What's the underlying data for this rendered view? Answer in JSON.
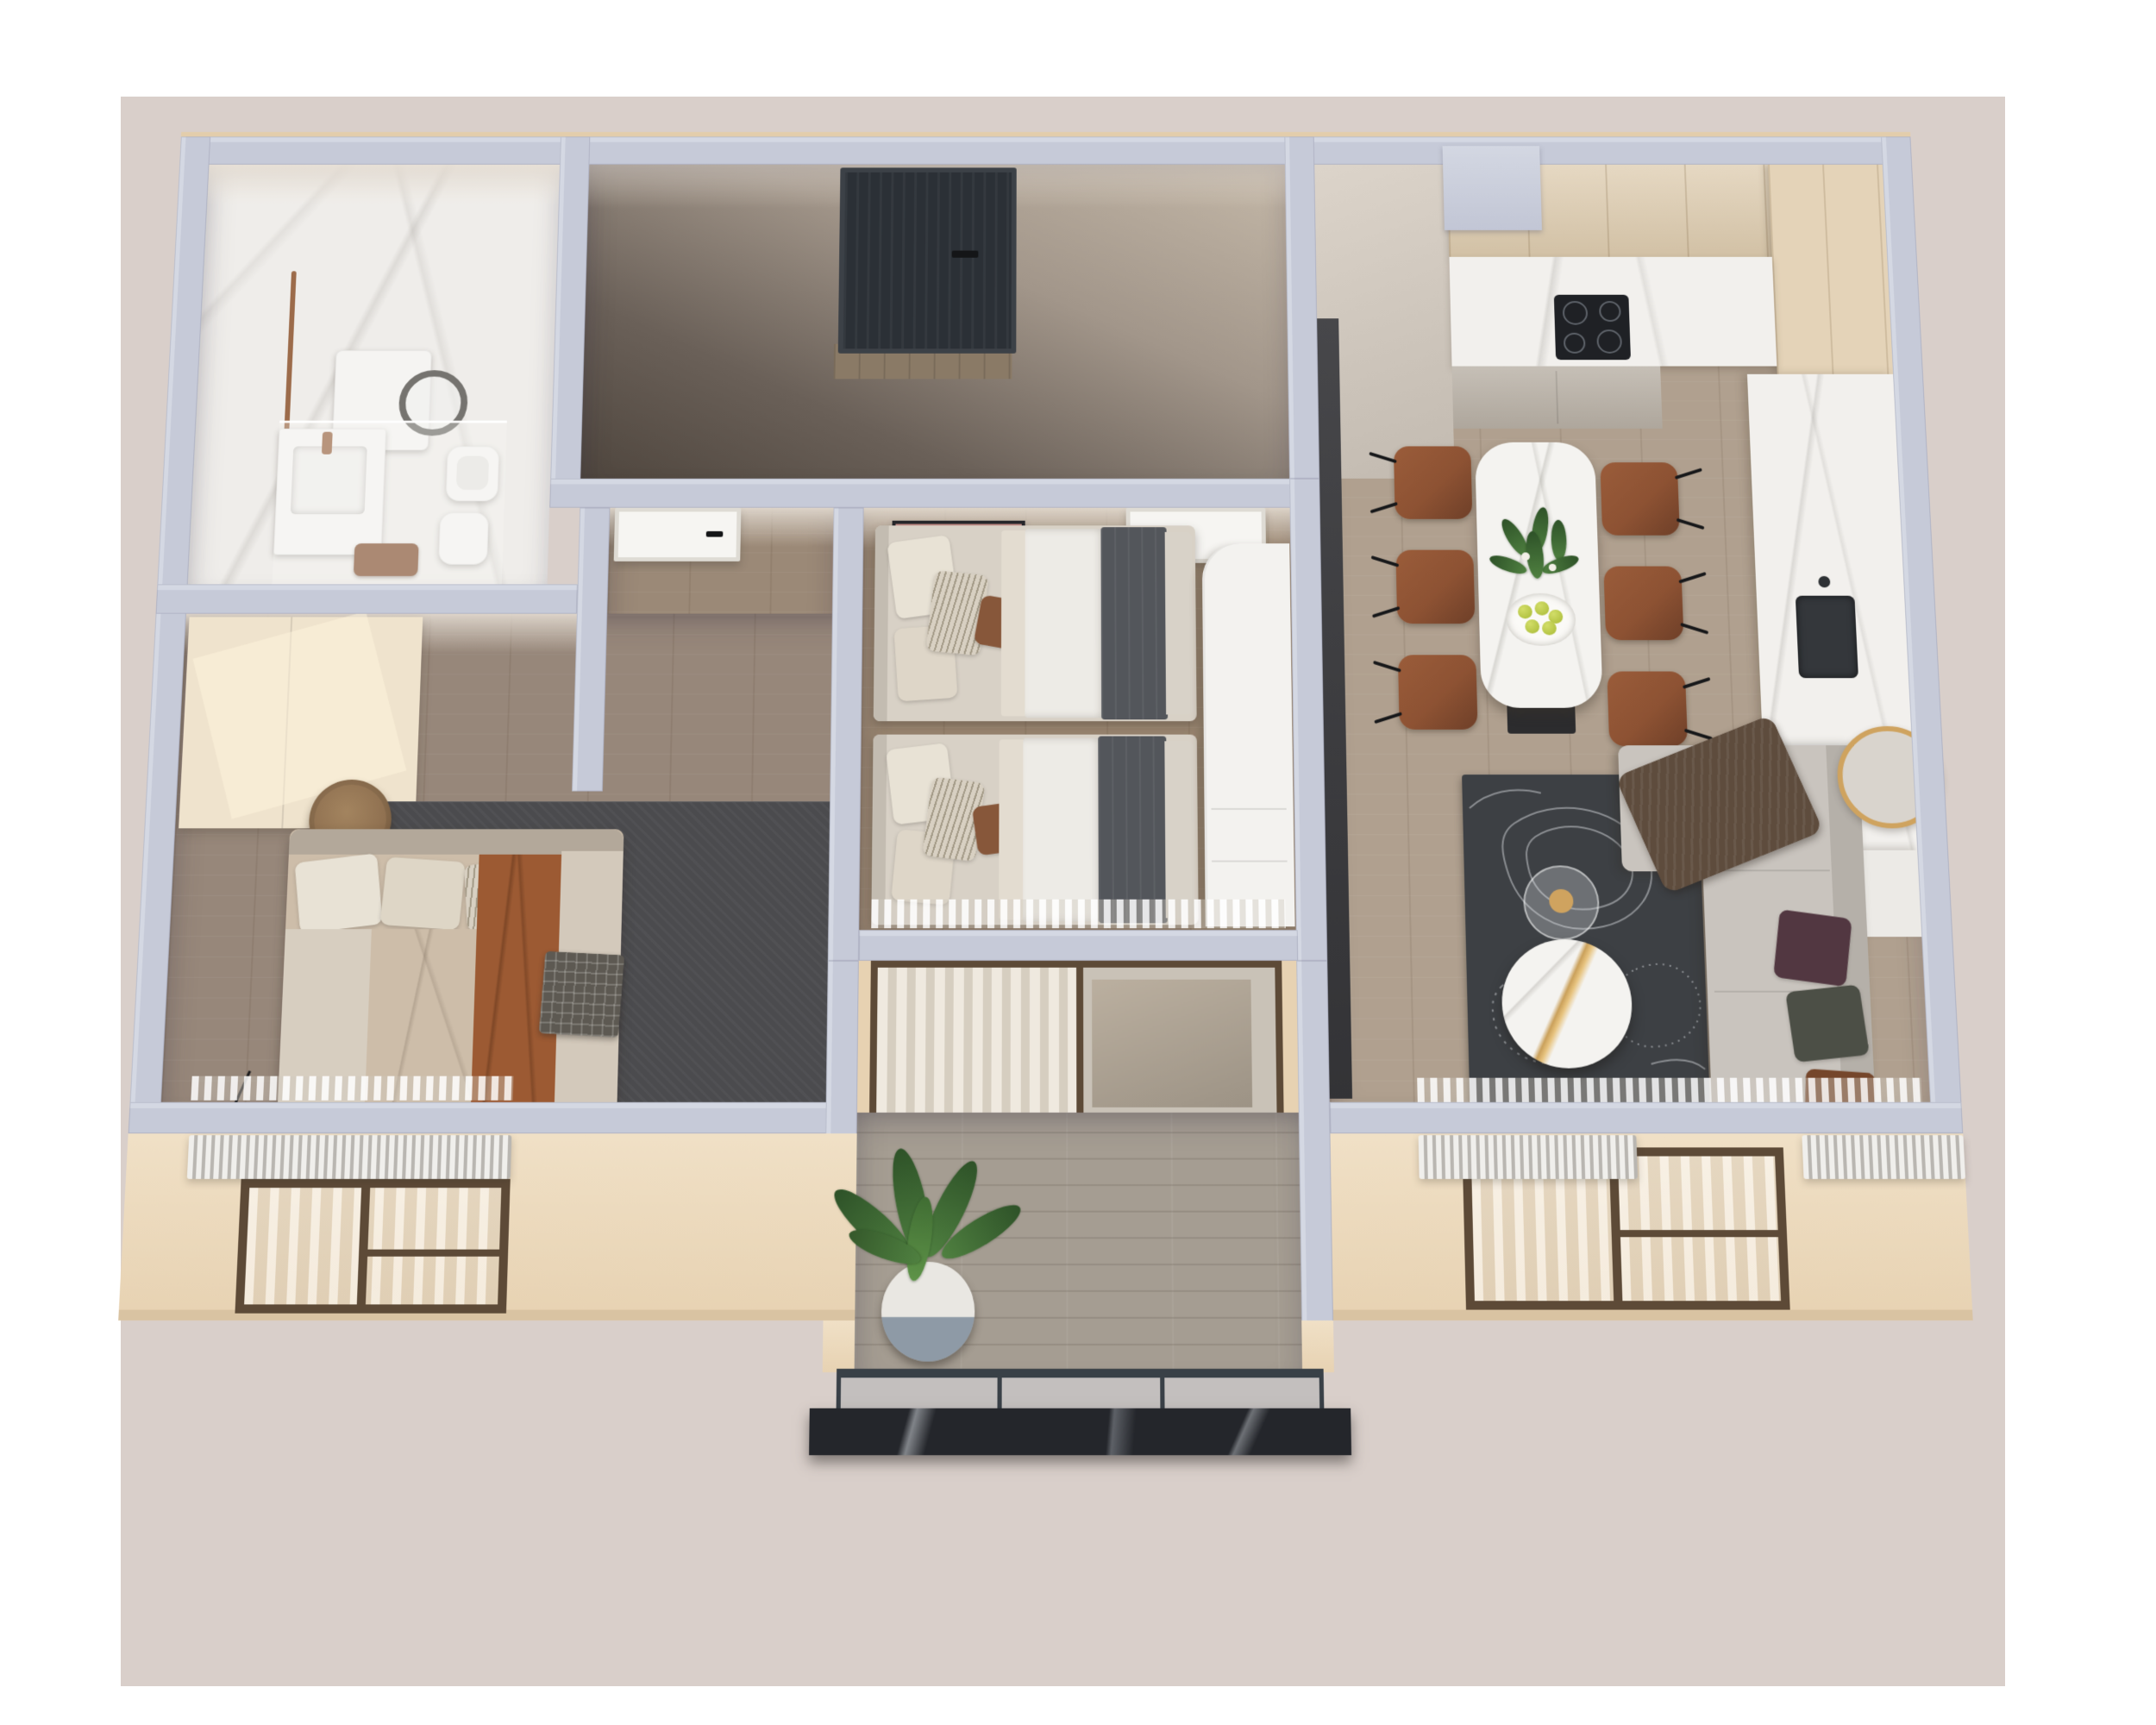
{
  "scene": {
    "kind": "isometric-3d-floor-plan-render",
    "rooms": {
      "bathroom": {
        "label": "Bathroom",
        "furniture": [
          "washing machine",
          "vanity sink",
          "shower glass panel",
          "toilet",
          "bidet",
          "copper towel rail",
          "brown towel"
        ]
      },
      "entry_hall": {
        "label": "Entry hall",
        "furniture": [
          "dark entrance door",
          "wood threshold"
        ]
      },
      "hallway": {
        "label": "Hallway",
        "furniture": [
          "white interior door",
          "light wood dresser"
        ]
      },
      "bedroom_master": {
        "label": "Master bedroom",
        "furniture": [
          "double bed",
          "rust throw blanket",
          "plaid blanket",
          "cream wardrobe",
          "round wood stool",
          "dark area rug",
          "floor lamp",
          "radiator",
          "curtains"
        ]
      },
      "bedroom_kids": {
        "label": "Second bedroom",
        "furniture": [
          "single bed upper",
          "single bed lower",
          "framed wall art",
          "white interior door",
          "white wardrobe",
          "sheer curtains"
        ]
      },
      "kitchen": {
        "label": "Kitchen",
        "furniture": [
          "upper cabinets",
          "tall cabinets",
          "marble counter",
          "induction cooktop",
          "dark sink",
          "white base cabinet"
        ]
      },
      "dining": {
        "label": "Dining area",
        "furniture": [
          "marble dining table",
          "six cognac leather chairs",
          "plant centerpiece",
          "plate of green apples"
        ]
      },
      "living": {
        "label": "Living area",
        "furniture": [
          "corner sofa",
          "three cushions",
          "brown throw",
          "topographic pattern rug",
          "round marble coffee table",
          "glass side table",
          "dark media panel",
          "round gold mirror",
          "radiators",
          "curtains"
        ]
      },
      "balcony": {
        "label": "Balcony",
        "furniture": [
          "sliding glass door",
          "sheer curtain",
          "potted banana plant",
          "glass railing",
          "dark marble ledge"
        ]
      }
    },
    "counts": {
      "dining_chairs": 6,
      "kids_beds": 2,
      "cooktop_burners": 4,
      "facade_windows": 2,
      "interior_white_doors": 3
    },
    "palette": {
      "backdrop": "#d9cfca",
      "wallTop": "#c6cad8",
      "wallEdge": "#e3cdab",
      "facade": "#e7d2b2",
      "facadeShade": "#d9c3a2",
      "marbleFloor": "#efedea",
      "counterMarble": "#f2f0ed",
      "entranceDoor": "#2b3036",
      "doorWhite": "#f6f5f2",
      "frameBronze": "#5d4a37",
      "rugLiving": "#3d4044",
      "rugBedroom": "#4b4b4e",
      "topoLine": "#c9ccd0",
      "sofa": "#c9c4be",
      "sofaBack": "#b5b0a9",
      "pillowMaroon": "#523741",
      "pillowOlive": "#4c4f46",
      "pillowBrown": "#75462b",
      "throwSofa": "#5e4c3d",
      "chairCognac": "#8d5233",
      "chairDark": "#6e3f28",
      "tableMarble": "#f4f3f0",
      "tableLeg": "#2c2c2e",
      "goldAccent": "#cfa35f",
      "creamWardrobe": "#efe3cd",
      "dresserWood": "#dcc9ac",
      "bedSheet": "#d8d1c6",
      "bedDuvet": "#edebe6",
      "bedBlanketDark": "#53565b",
      "masterDuvet": "#cdbda9",
      "rustThrow": "#9c5a33",
      "plaid": "#5d5952",
      "pillowLight": "#e8e2d5",
      "pillowPattern": "#a39a87",
      "stoolWood": "#8f7050",
      "fixtureWhite": "#f5f4f2",
      "copper": "#9c6b4a",
      "cooktop": "#1f2125",
      "sinkDark": "#34373b",
      "cabinetUpper": "#ddcbae",
      "cabinetTall": "#e4d3b8",
      "cabinetLower": "#b9b1a6",
      "ledge": "#24262b",
      "railFrame": "#394047",
      "plantGreen": "#4f8040",
      "plantGreenDark": "#2e5228",
      "potWhite": "#e9e7e2",
      "potBlue": "#8e9aa6",
      "appleGreen": "#a8ba35",
      "artPink": "#c08a85",
      "artRed": "#cf3b22",
      "artTeal": "#39b3a6",
      "artYellow": "#e5d44c",
      "artHair": "#d9a93a",
      "radiatorLight": "#f0efec",
      "radiatorDark": "#b9b6b1"
    }
  }
}
